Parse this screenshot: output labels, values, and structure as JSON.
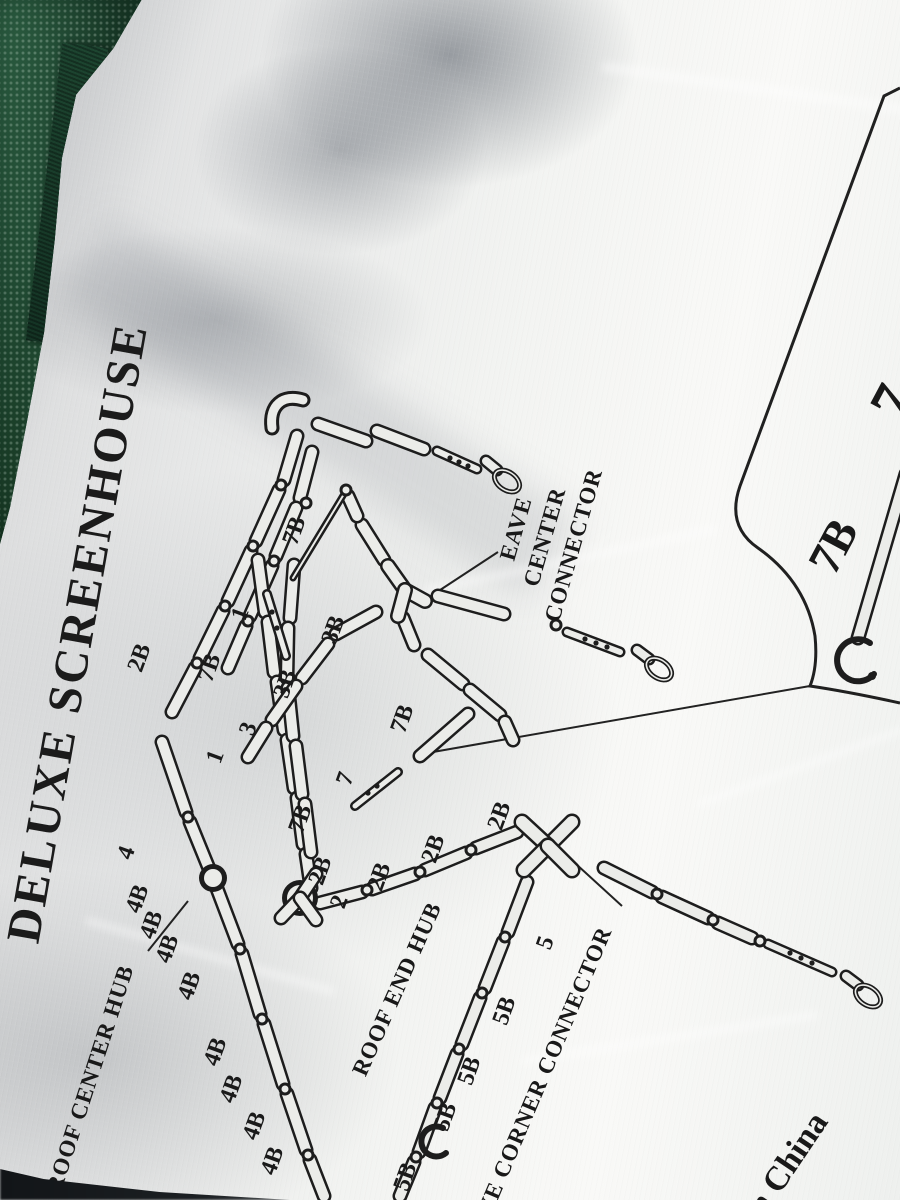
{
  "scene": {
    "title": "DELUXE SCREENHOUSE",
    "origin_text": "In China"
  },
  "labels": {
    "roof_center_hub": "ROOF CENTER HUB",
    "roof_end_hub": "ROOF END HUB",
    "eave_center_lines": [
      "EAVE",
      "CENTER",
      "CONNECTOR"
    ],
    "eave_corner_connector": "EAVE CORNER CONNECTOR"
  },
  "inset": {
    "label_large": "7B",
    "label_cut": "7"
  },
  "part_labels": [
    {
      "text": "2B",
      "x": 140,
      "y": 658,
      "r": -70
    },
    {
      "text": "7B",
      "x": 210,
      "y": 668,
      "r": -70
    },
    {
      "text": "1",
      "x": 241,
      "y": 614,
      "r": -70
    },
    {
      "text": "3B",
      "x": 334,
      "y": 630,
      "r": -70
    },
    {
      "text": "3B",
      "x": 286,
      "y": 684,
      "r": -70
    },
    {
      "text": "3",
      "x": 249,
      "y": 729,
      "r": -70
    },
    {
      "text": "1",
      "x": 216,
      "y": 757,
      "r": -70
    },
    {
      "text": "7B",
      "x": 295,
      "y": 531,
      "r": -70
    },
    {
      "text": "7",
      "x": 346,
      "y": 779,
      "r": -70
    },
    {
      "text": "7B",
      "x": 403,
      "y": 719,
      "r": -70
    },
    {
      "text": "7B",
      "x": 301,
      "y": 819,
      "r": -70
    },
    {
      "text": "2B",
      "x": 321,
      "y": 871,
      "r": -70
    },
    {
      "text": "2",
      "x": 340,
      "y": 902,
      "r": -70
    },
    {
      "text": "2B",
      "x": 380,
      "y": 877,
      "r": -70
    },
    {
      "text": "2B",
      "x": 434,
      "y": 849,
      "r": -70
    },
    {
      "text": "2B",
      "x": 500,
      "y": 816,
      "r": -70
    },
    {
      "text": "4",
      "x": 127,
      "y": 853,
      "r": -70
    },
    {
      "text": "4B",
      "x": 138,
      "y": 899,
      "r": -70
    },
    {
      "text": "4B",
      "x": 152,
      "y": 925,
      "r": -70
    },
    {
      "text": "4B",
      "x": 168,
      "y": 949,
      "r": -70
    },
    {
      "text": "4B",
      "x": 190,
      "y": 986,
      "r": -70
    },
    {
      "text": "4B",
      "x": 216,
      "y": 1052,
      "r": -70
    },
    {
      "text": "4B",
      "x": 232,
      "y": 1089,
      "r": -70
    },
    {
      "text": "4B",
      "x": 255,
      "y": 1126,
      "r": -70
    },
    {
      "text": "4B",
      "x": 273,
      "y": 1161,
      "r": -70
    },
    {
      "text": "5",
      "x": 546,
      "y": 943,
      "r": -70
    },
    {
      "text": "5B",
      "x": 505,
      "y": 1011,
      "r": -70
    },
    {
      "text": "5B",
      "x": 470,
      "y": 1071,
      "r": -70
    },
    {
      "text": "5B",
      "x": 446,
      "y": 1117,
      "r": -70
    },
    {
      "text": "5B",
      "x": 406,
      "y": 1177,
      "r": -70
    }
  ]
}
